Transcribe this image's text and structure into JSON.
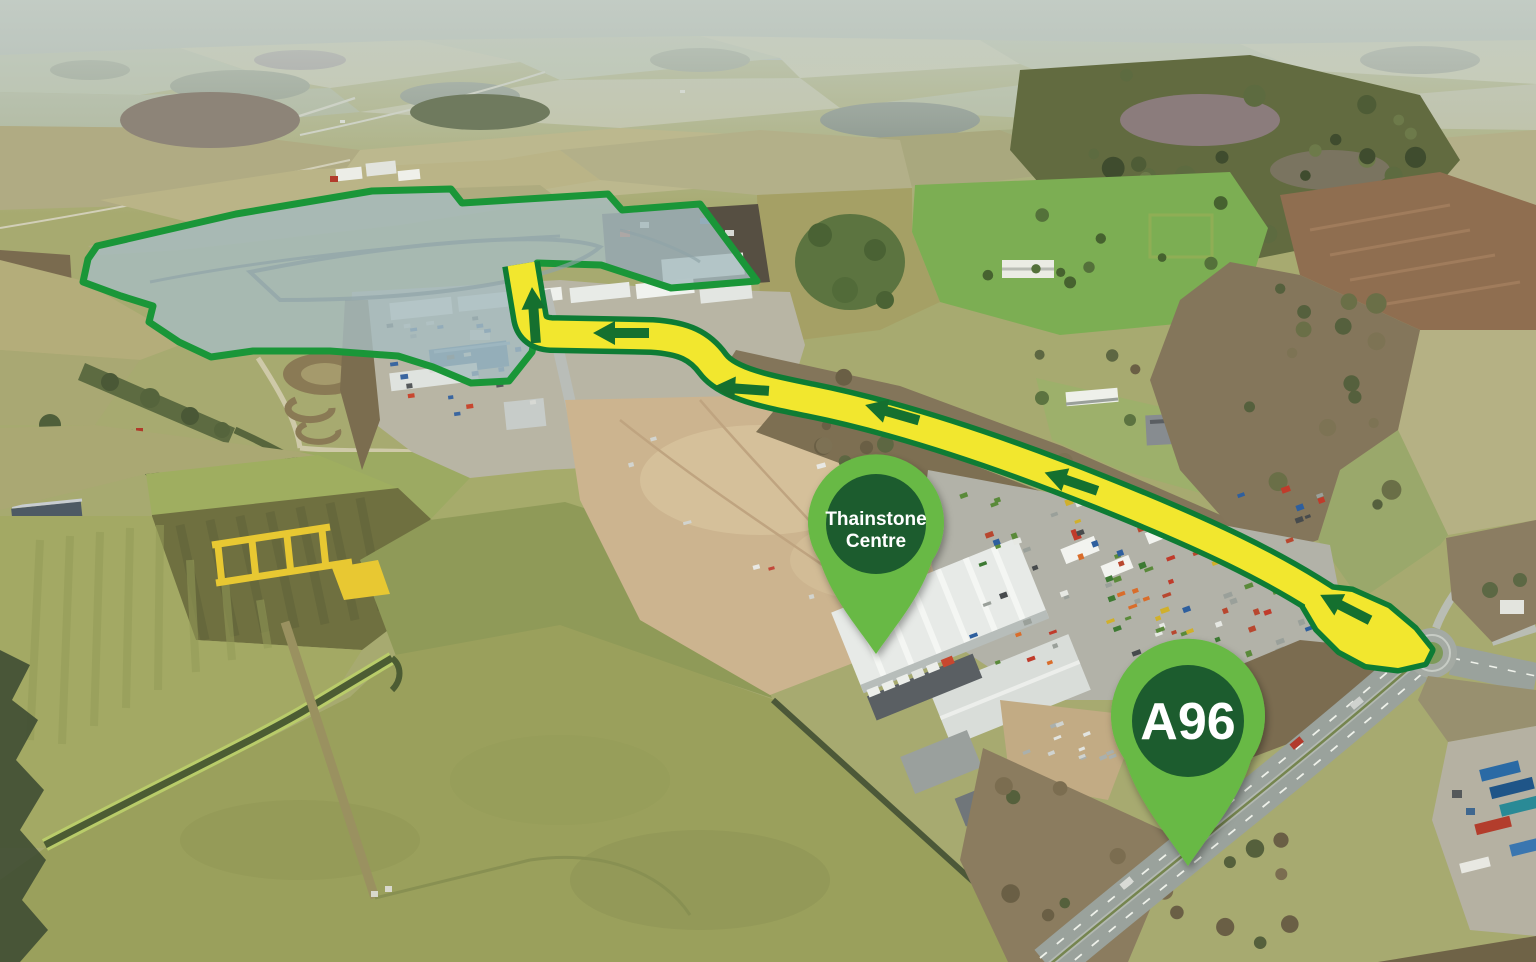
{
  "map": {
    "description_labels": [],
    "annotations": {
      "site_boundary": {
        "outline_color": "#1a9638",
        "fill_color": "rgba(167,188,192,0.82)"
      },
      "route": {
        "road_color": "#f2e72e",
        "border_color": "#0e7c34",
        "arrow_color": "#15702f",
        "arrow_count": 6
      },
      "pins": [
        {
          "id": "thainstone-centre",
          "label_lines": [
            "Thainstone",
            "Centre"
          ],
          "outer_color": "#67b944",
          "inner_color": "#1e5c2e",
          "text_color": "#ffffff"
        },
        {
          "id": "a96",
          "label_lines": [
            "A96"
          ],
          "outer_color": "#67b944",
          "inner_color": "#1e5c2e",
          "text_color": "#ffffff"
        }
      ]
    }
  }
}
